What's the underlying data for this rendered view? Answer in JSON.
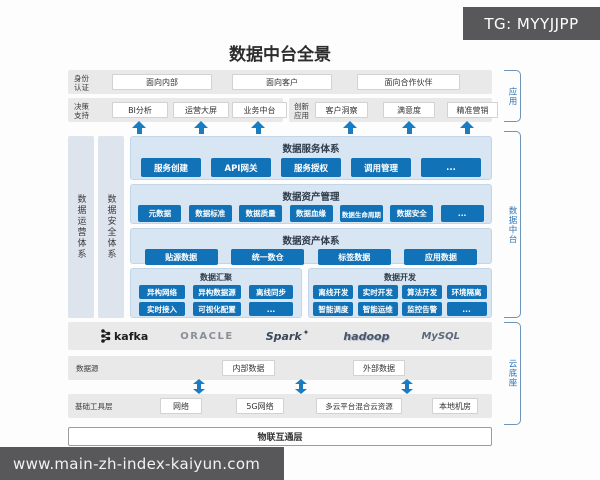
{
  "title": "数据中台全景",
  "watermark_top": "TG: MYYJJPP",
  "watermark_bottom": "www.main-zh-index-kaiyun.com",
  "side_brackets": {
    "app": "应用",
    "mid": "数据中台",
    "cloud": "云底座"
  },
  "pillars": {
    "ops": "数据运营体系",
    "security": "数据安全体系"
  },
  "rows": {
    "identity": {
      "label": "身份认证",
      "items": [
        "面向内部",
        "面向客户",
        "面向合作伙伴"
      ]
    },
    "decision": {
      "label": "决策支持",
      "items": [
        "BI分析",
        "运营大屏",
        "业务中台"
      ]
    },
    "innovation": {
      "label": "创新应用",
      "items": [
        "客户洞察",
        "满意度",
        "精准营销"
      ]
    }
  },
  "panels": {
    "service": {
      "title": "数据服务体系",
      "items": [
        "服务创建",
        "API网关",
        "服务授权",
        "调用管理",
        "..."
      ]
    },
    "asset_mgmt": {
      "title": "数据资产管理",
      "items": [
        "元数据",
        "数据标准",
        "数据质量",
        "数据血缘",
        "数据生命周期",
        "数据安全",
        "..."
      ]
    },
    "asset_sys": {
      "title": "数据资产体系",
      "items": [
        "贴源数据",
        "统一数仓",
        "标签数据",
        "应用数据"
      ]
    },
    "aggregation": {
      "title": "数据汇聚",
      "row1": [
        "异构网络",
        "异构数据源",
        "离线同步"
      ],
      "row2": [
        "实时接入",
        "可视化配置",
        "..."
      ]
    },
    "development": {
      "title": "数据开发",
      "row1": [
        "离线开发",
        "实时开发",
        "算法开发",
        "环境隔离"
      ],
      "row2": [
        "智能调度",
        "智能运维",
        "监控告警",
        "..."
      ]
    }
  },
  "logos": [
    "kafka",
    "ORACLE",
    "Spark",
    "hadoop",
    "MySQL"
  ],
  "cloud": {
    "datasource": {
      "label": "数据源",
      "items": [
        "内部数据",
        "外部数据"
      ]
    },
    "infra": {
      "label": "基础工具层",
      "items": [
        "网络",
        "5G网络",
        "多云平台混合云资源",
        "本地机房"
      ]
    },
    "iot": "物联互通层"
  },
  "colors": {
    "button_blue": "#1272b7",
    "panel_blue": "#d8e5f2",
    "arrow_blue": "#1a7dc2",
    "bracket_blue": "#2e75b6",
    "bar_gray": "#e9e9e9",
    "watermark_gray": "#58585a"
  }
}
